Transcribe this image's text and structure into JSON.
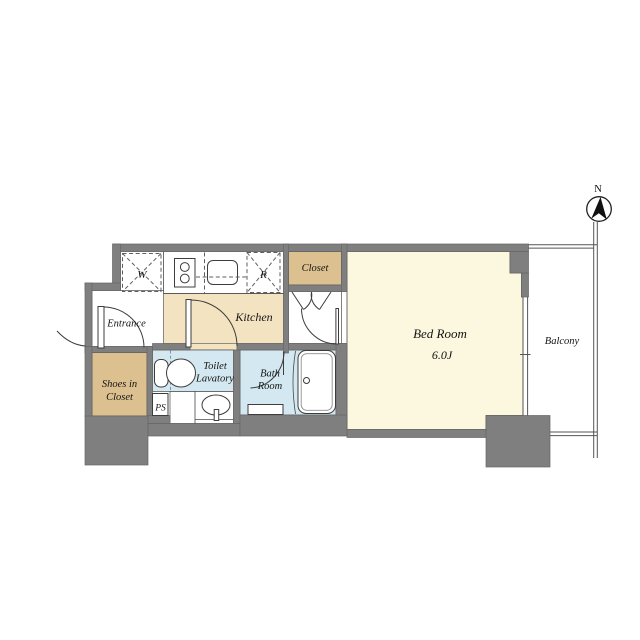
{
  "plan": {
    "labels": {
      "entrance": "Entrance",
      "shoes_line1": "Shoes in",
      "shoes_line2": "Closet",
      "ps": "PS",
      "washer": "W",
      "fridge": "R",
      "kitchen": "Kitchen",
      "closet": "Closet",
      "toilet_line1": "Toilet",
      "toilet_line2": "Lavatory",
      "bath_line1": "Bath",
      "bath_line2": "Room",
      "bedroom_name": "Bed Room",
      "bedroom_size": "6.0J",
      "balcony": "Balcony",
      "north": "N"
    },
    "colors": {
      "wall": "#7f7f7f",
      "kitchen_floor": "#f3e3c1",
      "closet_floor": "#dcc08f",
      "bedroom_floor": "#fbf8df",
      "wet_area_floor": "#d3e8f0",
      "line": "#3d3d3d",
      "background": "#ffffff"
    }
  }
}
